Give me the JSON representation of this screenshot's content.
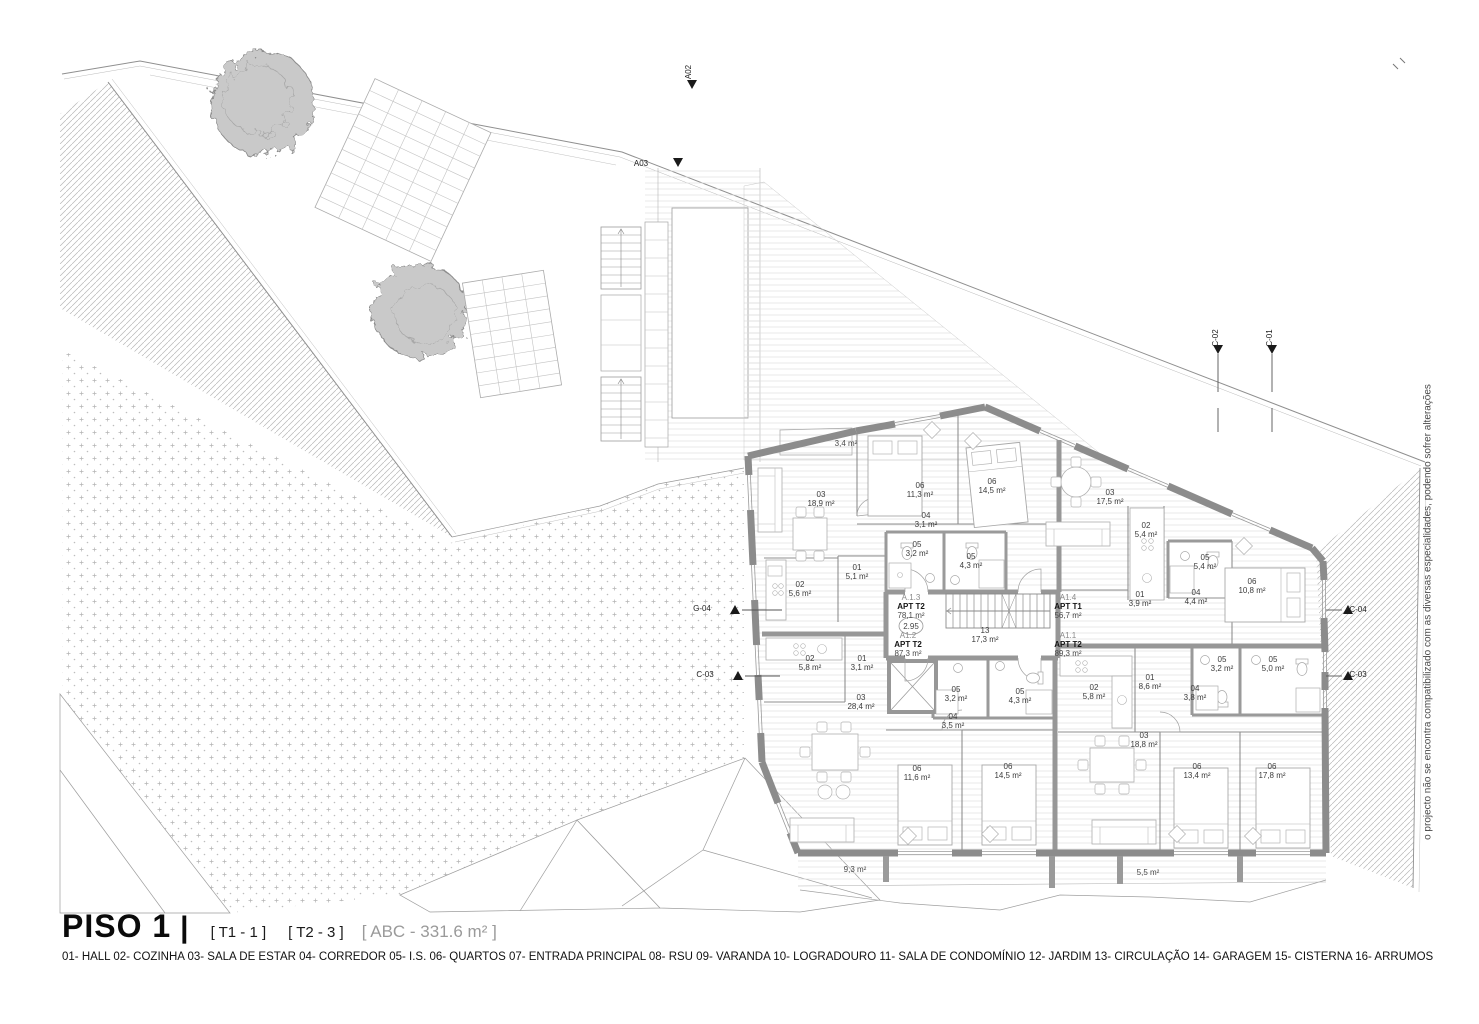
{
  "title": {
    "name": "PISO 1",
    "bar": "|",
    "tag_t1": "[ T1 - 1 ]",
    "tag_t2": "[ T2 - 3 ]",
    "tag_abc": "[ ABC - 331.6 m² ]"
  },
  "legend": "01- HALL 02- COZINHA 03- SALA DE ESTAR 04- CORREDOR 05- I.S. 06- QUARTOS 07- ENTRADA PRINCIPAL 08- RSU 09- VARANDA 10- LOGRADOURO 11- SALA DE CONDOMÍNIO 12- JARDIM 13- CIRCULAÇÃO 14- GARAGEM 15- CISTERNA 16- ARRUMOS",
  "side_note": "o projecto não se encontra compatibilizado com as diversas especialidades, podendo sofrer alterações",
  "level_marker": {
    "value": "2.95",
    "x": 911,
    "y": 629
  },
  "apartments": [
    {
      "id": "A.1.3",
      "type": "APT T2",
      "area": "78,1 m²",
      "x": 911,
      "y": 600
    },
    {
      "id": "A1.4",
      "type": "APT T1",
      "area": "56,7 m²",
      "x": 1068,
      "y": 600
    },
    {
      "id": "A1.2",
      "type": "APT T2",
      "area": "87,3 m²",
      "x": 908,
      "y": 638
    },
    {
      "id": "A1.1",
      "type": "APT T2",
      "area": "89,3 m²",
      "x": 1068,
      "y": 638
    }
  ],
  "rooms": [
    {
      "code": "03",
      "area": "18,9 m²",
      "x": 821,
      "y": 497
    },
    {
      "code": "06",
      "area": "11,3 m²",
      "x": 920,
      "y": 488
    },
    {
      "code": "06",
      "area": "14,5 m²",
      "x": 992,
      "y": 484
    },
    {
      "code": "04",
      "area": "3,1 m²",
      "x": 926,
      "y": 518
    },
    {
      "code": "05",
      "area": "3,2 m²",
      "x": 917,
      "y": 547
    },
    {
      "code": "05",
      "area": "4,3 m²",
      "x": 971,
      "y": 559
    },
    {
      "code": "01",
      "area": "5,1 m²",
      "x": 857,
      "y": 570
    },
    {
      "code": "02",
      "area": "5,6 m²",
      "x": 800,
      "y": 587
    },
    {
      "code": "03",
      "area": "17,5 m²",
      "x": 1110,
      "y": 495
    },
    {
      "code": "02",
      "area": "5,4 m²",
      "x": 1146,
      "y": 528
    },
    {
      "code": "05",
      "area": "5,4 m²",
      "x": 1205,
      "y": 560
    },
    {
      "code": "06",
      "area": "10,8 m²",
      "x": 1252,
      "y": 584
    },
    {
      "code": "01",
      "area": "3,9 m²",
      "x": 1140,
      "y": 597
    },
    {
      "code": "04",
      "area": "4,4 m²",
      "x": 1196,
      "y": 595
    },
    {
      "code": "13",
      "area": "17,3 m²",
      "x": 985,
      "y": 633
    },
    {
      "code": "02",
      "area": "5,8 m²",
      "x": 810,
      "y": 661
    },
    {
      "code": "01",
      "area": "3,1 m²",
      "x": 862,
      "y": 661
    },
    {
      "code": "03",
      "area": "28,4 m²",
      "x": 861,
      "y": 700
    },
    {
      "code": "05",
      "area": "3,2 m²",
      "x": 956,
      "y": 692
    },
    {
      "code": "05",
      "area": "4,3 m²",
      "x": 1020,
      "y": 694
    },
    {
      "code": "04",
      "area": "3,5 m²",
      "x": 953,
      "y": 719
    },
    {
      "code": "06",
      "area": "11,6 m²",
      "x": 917,
      "y": 771
    },
    {
      "code": "06",
      "area": "14,5 m²",
      "x": 1008,
      "y": 769
    },
    {
      "code": "02",
      "area": "5,8 m²",
      "x": 1094,
      "y": 690
    },
    {
      "code": "01",
      "area": "8,6 m²",
      "x": 1150,
      "y": 680
    },
    {
      "code": "05",
      "area": "3,2 m²",
      "x": 1222,
      "y": 662
    },
    {
      "code": "05",
      "area": "5,0 m²",
      "x": 1273,
      "y": 662
    },
    {
      "code": "04",
      "area": "3,8 m²",
      "x": 1195,
      "y": 691
    },
    {
      "code": "03",
      "area": "18,8 m²",
      "x": 1144,
      "y": 738
    },
    {
      "code": "06",
      "area": "13,4 m²",
      "x": 1197,
      "y": 769
    },
    {
      "code": "06",
      "area": "17,8 m²",
      "x": 1272,
      "y": 769
    }
  ],
  "outdoor_labels": [
    {
      "label": "3,4 m²",
      "x": 846,
      "y": 446
    },
    {
      "label": "9,3 m²",
      "x": 855,
      "y": 872
    },
    {
      "label": "5,5 m²",
      "x": 1148,
      "y": 875
    }
  ],
  "section_markers": [
    {
      "label": "A02",
      "x": 691,
      "y": 72,
      "rot": -90
    },
    {
      "label": "A03",
      "x": 641,
      "y": 166,
      "rot": 0
    },
    {
      "label": "C-02",
      "x": 1218,
      "y": 338,
      "rot": -90
    },
    {
      "label": "C-01",
      "x": 1272,
      "y": 338,
      "rot": -90
    },
    {
      "label": "G-04",
      "x": 702,
      "y": 611,
      "rot": 0
    },
    {
      "label": "C-03",
      "x": 705,
      "y": 677,
      "rot": 0
    },
    {
      "label": "C-04",
      "x": 1358,
      "y": 612,
      "rot": 0
    },
    {
      "label": "C-03",
      "x": 1358,
      "y": 677,
      "rot": 0
    }
  ]
}
